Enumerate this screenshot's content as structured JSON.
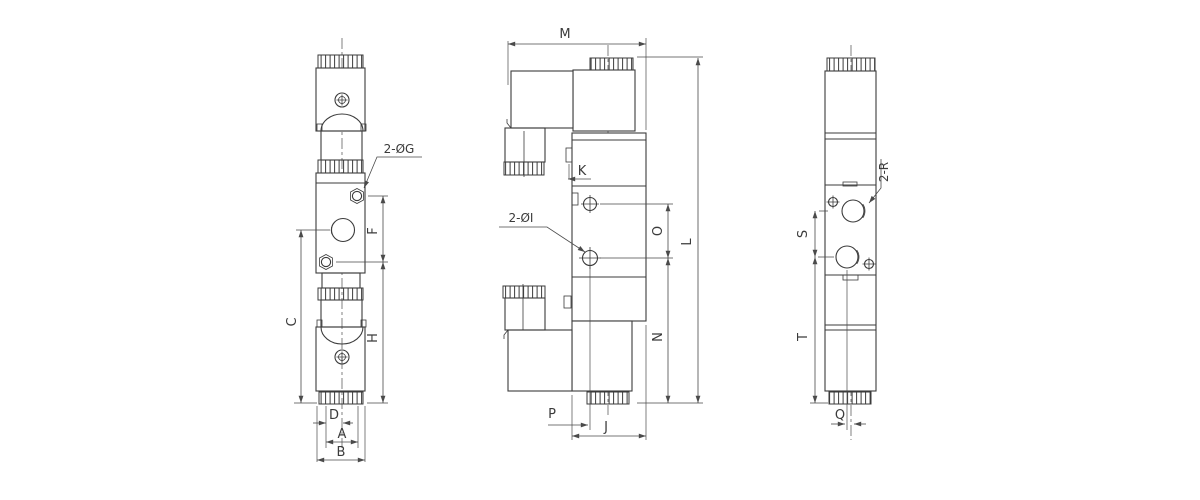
{
  "drawing": {
    "title": "solenoid-valve-dimension-drawing",
    "background": "#ffffff",
    "line_color": "#3b3b3b",
    "dim_color": "#4a4a4a",
    "views": {
      "front": {
        "name": "front-view",
        "port_note": "2-ØG",
        "dims": {
          "f": "F",
          "c": "C",
          "h": "H",
          "d": "D",
          "a": "A",
          "b": "B"
        }
      },
      "side": {
        "name": "side-view",
        "port_note": "2-ØI",
        "dims": {
          "m": "M",
          "k": "K",
          "o": "O",
          "l": "L",
          "n": "N",
          "p": "P",
          "j": "J"
        }
      },
      "rear": {
        "name": "rear-view",
        "port_note": "2-R",
        "dims": {
          "s": "S",
          "t": "T",
          "q": "Q"
        }
      }
    }
  }
}
